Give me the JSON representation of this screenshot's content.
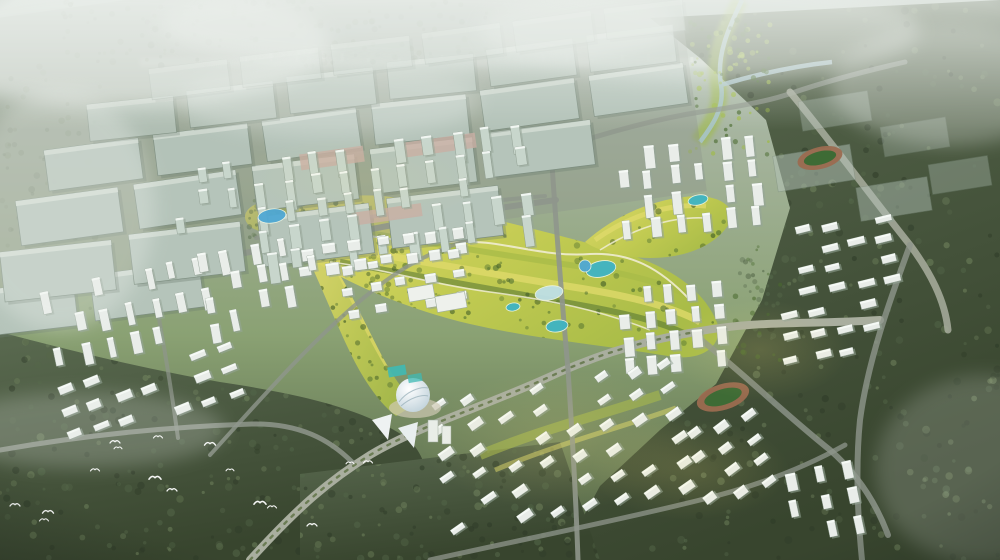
{
  "meta": {
    "title": "Aerial master-plan rendering",
    "description": "Bird's-eye architectural rendering of an urban master plan: misty industrial grid at top, dense mid-rise CBD, a diagonal central park with teal lakes, white residential slab and tower districts, two running-track sports fields, a white dome landmark, dark forest belts at the edges and white birds flying over the south-west woodland.",
    "icons": {
      "bird": "bird-icon"
    }
  },
  "palette": {
    "haze_white": "#eef2ee",
    "sky_top": "#b7c3bb",
    "ground_mid": "#8aa173",
    "ground_deep": "#4e5f41",
    "forest_hi": "#5a6a50",
    "forest_lo": "#38452e",
    "forest_dot_a": "#2e3a28",
    "forest_dot_b": "#55684a",
    "forest_dot_c": "#73865f",
    "industrial_roof": "#b5c4ba",
    "industrial_roof_light": "#d2dcd3",
    "industrial_shadow": "#6d7f6f",
    "road": "#8f968c",
    "road_light": "#a9ae9f",
    "median_green": "#5c7042",
    "park_yellow": "#dfd96a",
    "park_green": "#a9bc48",
    "park_green2": "#9fbc3f",
    "park_tree": "#4a6b2f",
    "park_deep": "#2f4d22",
    "path_cream": "#efecd2",
    "lake_teal": "#3fb4c4",
    "lake_blue": "#4fa8d4",
    "lake_pale": "#bfe0e6",
    "tower_white": "#e9ede9",
    "tower_shadow": "#96a598",
    "cbd_block": "#c8d6cc",
    "plaza_pink": "#c9afa4",
    "dome_white": "#eef2f4",
    "track_rim": "#9b6b50",
    "field_green": "#3e6b35",
    "court_aqua": "#3fb9b4",
    "river": "#a8c4cc",
    "bird_white": "#ffffff",
    "glow_warm": "#f5e27a",
    "skyline": "#e2e8de"
  },
  "scene": {
    "industrial": {
      "rows": [
        {
          "x": -34,
          "y": 286,
          "n": 2,
          "w": 110,
          "h": 46,
          "gap": 16,
          "dy": 18,
          "tilt": -7,
          "op": 1
        },
        {
          "x": 2,
          "y": 246,
          "n": 4,
          "w": 112,
          "h": 50,
          "gap": 17,
          "dy": 18,
          "tilt": -7,
          "op": 1
        },
        {
          "x": 18,
          "y": 194,
          "n": 5,
          "w": 103,
          "h": 45,
          "gap": 15,
          "dy": 17,
          "tilt": -7,
          "op": 1
        },
        {
          "x": 46,
          "y": 144,
          "n": 6,
          "w": 95,
          "h": 41,
          "gap": 14,
          "dy": 15,
          "tilt": -7,
          "op": 0.95
        },
        {
          "x": 88,
          "y": 100,
          "n": 6,
          "w": 87,
          "h": 37,
          "gap": 13,
          "dy": 14,
          "tilt": -7,
          "op": 0.8
        },
        {
          "x": 150,
          "y": 64,
          "n": 6,
          "w": 79,
          "h": 31,
          "gap": 12,
          "dy": 12,
          "tilt": -7,
          "op": 0.55
        }
      ],
      "extra": [
        [
          775,
          150,
          78,
          36,
          -9,
          0.5
        ],
        [
          858,
          182,
          72,
          34,
          -9,
          0.45
        ],
        [
          800,
          96,
          70,
          30,
          -9,
          0.35
        ],
        [
          882,
          122,
          66,
          30,
          -9,
          0.3
        ],
        [
          930,
          160,
          60,
          30,
          -9,
          0.35
        ]
      ]
    },
    "clusters": [
      {
        "n": "cbd-towers",
        "x": 258,
        "y": 140,
        "cols": 10,
        "rows": 5,
        "dx": 29,
        "dy": 23,
        "bw": 9,
        "bh": 18,
        "jh": 14,
        "rot": -8,
        "brot": 0,
        "skip": 0.18,
        "fill": "cbd_block"
      },
      {
        "n": "cbd-lowrise",
        "x": 300,
        "y": 236,
        "cols": 7,
        "rows": 2,
        "dx": 26,
        "dy": 18,
        "bw": 12,
        "bh": 8,
        "jh": 4,
        "rot": -8,
        "brot": 0,
        "skip": 0.2,
        "fill": "tower_white"
      },
      {
        "n": "nw-towers",
        "x": 175,
        "y": 165,
        "cols": 3,
        "rows": 3,
        "dx": 26,
        "dy": 24,
        "bw": 8,
        "bh": 14,
        "jh": 6,
        "rot": -8,
        "brot": 0,
        "skip": 0.2,
        "fill": "cbd_block"
      },
      {
        "n": "left-res-towers",
        "x": 48,
        "y": 268,
        "cols": 8,
        "rows": 3,
        "dx": 26,
        "dy": 30,
        "bw": 8,
        "bh": 17,
        "jh": 8,
        "rot": -12,
        "brot": 0,
        "skip": 0.15,
        "fill": "tower_white"
      },
      {
        "n": "left-res-slabs",
        "x": 60,
        "y": 362,
        "cols": 7,
        "rows": 3,
        "dx": 28,
        "dy": 24,
        "bw": 15,
        "bh": 6,
        "jh": 3,
        "rot": -14,
        "brot": -8,
        "skip": 0.2,
        "fill": "tower_white"
      },
      {
        "n": "west-park-towers",
        "x": 205,
        "y": 240,
        "cols": 5,
        "rows": 4,
        "dx": 27,
        "dy": 24,
        "bw": 8,
        "bh": 15,
        "jh": 7,
        "rot": -10,
        "brot": 0,
        "skip": 0.25,
        "fill": "tower_white"
      },
      {
        "n": "midwest-lowrise",
        "x": 345,
        "y": 255,
        "cols": 5,
        "rows": 3,
        "dx": 27,
        "dy": 22,
        "bw": 11,
        "bh": 7,
        "jh": 3,
        "rot": -9,
        "brot": 0,
        "skip": 0.2,
        "fill": "tower_white"
      },
      {
        "n": "ne-res-towers",
        "x": 620,
        "y": 140,
        "cols": 6,
        "rows": 4,
        "dx": 26,
        "dy": 24,
        "bw": 9,
        "bh": 16,
        "jh": 8,
        "rot": -6,
        "brot": 0,
        "skip": 0.15,
        "fill": "tower_white"
      },
      {
        "n": "east-res-towers",
        "x": 623,
        "y": 285,
        "cols": 5,
        "rows": 4,
        "dx": 23,
        "dy": 23,
        "bw": 9,
        "bh": 14,
        "jh": 6,
        "rot": -5,
        "brot": 0,
        "skip": 0.12,
        "fill": "tower_white"
      },
      {
        "n": "far-east-slabs",
        "x": 798,
        "y": 220,
        "cols": 4,
        "rows": 4,
        "dx": 27,
        "dy": 21,
        "bw": 16,
        "bh": 6,
        "jh": 2,
        "rot": -8,
        "brot": -6,
        "skip": 0.15,
        "fill": "tower_white"
      },
      {
        "n": "far-east-slabs-b",
        "x": 783,
        "y": 305,
        "cols": 4,
        "rows": 3,
        "dx": 28,
        "dy": 22,
        "bw": 15,
        "bh": 6,
        "jh": 2,
        "rot": -8,
        "brot": -6,
        "skip": 0.2,
        "fill": "tower_white"
      },
      {
        "n": "south-district",
        "x": 440,
        "y": 382,
        "cols": 8,
        "rows": 6,
        "dx": 33,
        "dy": 25,
        "bw": 14,
        "bh": 6,
        "jh": 3,
        "rot": -10,
        "brot": -25,
        "skip": 0.18,
        "fill": "tower_white"
      },
      {
        "n": "south-east-block",
        "x": 695,
        "y": 420,
        "cols": 3,
        "rows": 4,
        "dx": 30,
        "dy": 23,
        "bw": 13,
        "bh": 6,
        "jh": 3,
        "rot": -15,
        "brot": -22,
        "skip": 0.2,
        "fill": "tower_white"
      },
      {
        "n": "bottom-right-towers",
        "x": 793,
        "y": 465,
        "cols": 3,
        "rows": 3,
        "dx": 28,
        "dy": 27,
        "bw": 9,
        "bh": 14,
        "jh": 6,
        "rot": -12,
        "brot": 0,
        "skip": 0.15,
        "fill": "tower_white"
      }
    ],
    "lakes": [
      [
        272,
        216,
        14,
        7,
        -8,
        "lake_blue"
      ],
      [
        601,
        269,
        15,
        8,
        -12,
        "lake_teal"
      ],
      [
        585,
        266,
        6,
        6,
        0,
        "lake_blue"
      ],
      [
        549,
        293,
        14,
        7,
        -10,
        "lake_pale"
      ],
      [
        557,
        326,
        11,
        6,
        -8,
        "lake_teal"
      ],
      [
        513,
        307,
        7,
        4,
        -8,
        "lake_teal"
      ],
      [
        698,
        200,
        10,
        5,
        -12,
        "lake_teal"
      ]
    ],
    "stadiums": [
      [
        820,
        158,
        23,
        11,
        -14
      ],
      [
        723,
        397,
        27,
        13,
        -17
      ]
    ],
    "birds": [
      [
        15,
        505,
        1
      ],
      [
        48,
        512,
        1.1
      ],
      [
        44,
        520,
        0.9
      ],
      [
        95,
        470,
        0.9
      ],
      [
        115,
        442,
        1
      ],
      [
        118,
        448,
        0.8
      ],
      [
        155,
        478,
        1.2
      ],
      [
        172,
        490,
        1
      ],
      [
        158,
        437,
        0.9
      ],
      [
        210,
        444,
        1.1
      ],
      [
        230,
        470,
        0.8
      ],
      [
        260,
        503,
        1.2
      ],
      [
        272,
        507,
        0.9
      ],
      [
        312,
        525,
        1
      ],
      [
        350,
        463,
        0.8
      ],
      [
        368,
        462,
        0.9
      ]
    ]
  }
}
